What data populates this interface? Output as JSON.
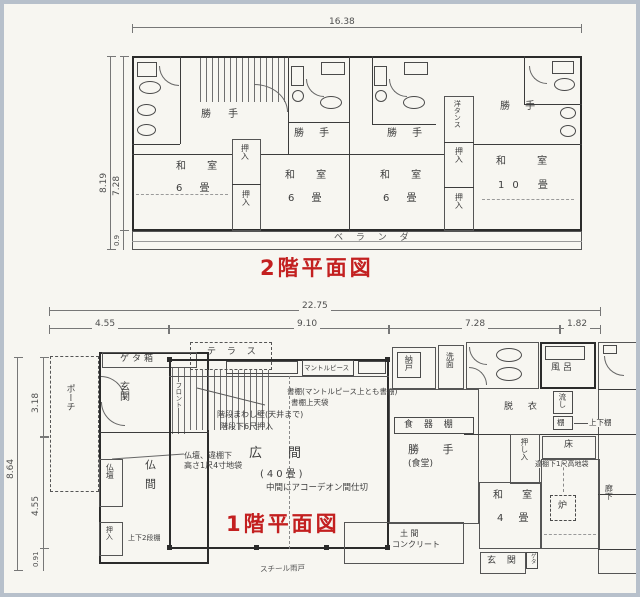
{
  "colors": {
    "paper": "#f7f6f1",
    "ink": "#3a3a3a",
    "title_red": "#c32020",
    "frame": "#b7c0cb"
  },
  "plan2f": {
    "title": "2階平面図",
    "dims": {
      "top": "16.38",
      "left_total": "8.19",
      "left_main": "7.28",
      "left_balcony": "0.9"
    },
    "labels": {
      "katte": "勝 手",
      "washitsu": "和 室",
      "mats6": "6 畳",
      "washitsu10": "和  室",
      "mats10": "10 畳",
      "oshiire": "押入",
      "yo_tansu": "洋タンス",
      "veranda": "ベ ラ ン ダ"
    }
  },
  "plan1f": {
    "title": "1階平面図",
    "dims": {
      "top_total": "22.75",
      "top_seg1": "4.55",
      "top_seg2": "9.10",
      "top_seg3": "7.28",
      "top_seg4": "1.82",
      "left_total": "8.64",
      "left_seg1": "3.18",
      "left_seg2": "4.55",
      "left_seg3": "0.91"
    },
    "labels": {
      "getabako": "ゲタ箱",
      "terrace": "テ ラ ス",
      "porch": "ポーチ",
      "genkan": "玄関",
      "front": "フロント",
      "stair_note1": "階段まわし壁(天井まで)",
      "stair_note2": "階段下6尺押入",
      "mantelpiece": "マントルピース",
      "shelf_note1": "書棚(マントルピース上とも書棚)",
      "shelf_note2": "書棚上天袋",
      "hiroma": "広間",
      "hiroma_mats": "(40畳)",
      "accordion_note": "中間にアコーデオン間仕切",
      "butsudan": "仏壇",
      "butsuma": "仏間",
      "oshiire": "押入",
      "two_tier_note": "上下2段棚",
      "butsudan_note1": "仏壇、違棚下",
      "butsudan_note2": "高さ1尺4寸地袋",
      "nando": "納戸",
      "senmen": "洗面",
      "furo": "風呂",
      "datsui": "脱 衣",
      "nagashi": "流し",
      "tana": "棚",
      "updown_tana_note": "上下棚",
      "toko": "床",
      "chigaidana_note": "違棚下1尺高地袋",
      "oshiire_long": "押し入",
      "washitsu": "和 室",
      "mats4": "4 畳",
      "ro": "炉",
      "rouka": "廊下",
      "genkan2": "玄 関",
      "geta": "ゲタ",
      "doma_line1": "土 間",
      "doma_line2": "コンクリート",
      "steel_shutter_note": "スチール雨戸",
      "shokkidana": "食 器 棚",
      "katte": "勝 手",
      "shokudo": "(食堂)"
    }
  }
}
